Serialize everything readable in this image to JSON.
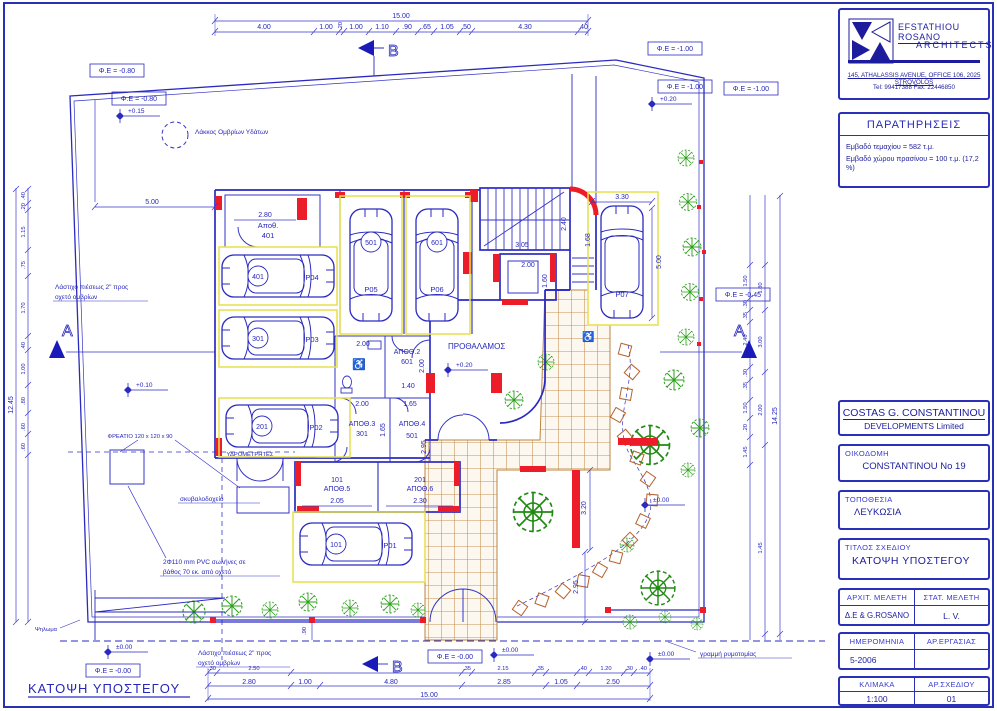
{
  "firm": {
    "name": "EFSTATHIOU ROSANO",
    "type": "ARCHITECTS",
    "address": "145, ATHALASSIS AVENUE, OFFICE 106, 2025 STROVOLOS",
    "contact": "Tel: 99417388    Fax: 22446850"
  },
  "remarks": {
    "title": "ΠΑΡΑΤΗΡΗΣΕΙΣ",
    "line1": "Εμβαδό τεμαχίου = 582 τ.μ.",
    "line2": "Εμβαδό χώρου πρασίνου = 100 τ.μ. (17,2 %)"
  },
  "client": {
    "name": "COSTAS G. CONSTANTINOU",
    "sub": "DEVELOPMENTS Limited"
  },
  "fields": {
    "building_label": "ΟΙΚΟΔΟΜΗ",
    "building": "CONSTANTINOU Νο 19",
    "location_label": "ΤΟΠΟΘΕΣΙΑ",
    "location": "ΛΕΥΚΩΣΙΑ",
    "title_label": "ΤΙΤΛΟΣ ΣΧΕΔΙΟΥ",
    "title": "ΚΑΤΟΨΗ ΥΠΟΣΤΕΓΟΥ",
    "arch_label": "ΑΡΧΙΤ. ΜΕΛΕΤΗ",
    "arch": "Δ.Ε & G.ROSANO",
    "struct_label": "ΣΤΑΤ. ΜΕΛΕΤΗ",
    "struct": "L. V.",
    "date_label": "ΗΜΕΡΟΜΗΝΙΑ",
    "date": "5-2006",
    "job_label": "ΑΡ.ΕΡΓΑΣΙΑΣ",
    "job": "",
    "scale_label": "ΚΛΙΜΑΚΑ",
    "scale": "1:100",
    "dwg_label": "ΑΡ.ΣΧΕΔΙΟΥ",
    "dwg": "01"
  },
  "plan": {
    "caption": "ΚΑΤΟΨΗ ΥΠΟΣΤΕΓΟΥ",
    "vestibule": "ΠΡΟΘΑΛΑΜΟΣ",
    "icons": {
      "wheelchair": "♿"
    },
    "notes": {
      "rain_pit": "Λάκκος Ομβρίων Υδάτων",
      "hose1": "Λάστιχο πιέσεως 2\" προς",
      "hose2": "οχετό ομβρίων",
      "street": "γραμμή ρυμοτομίας",
      "manhole": "ΦΡΕΑΤΙΟ 120 x 120 x 90",
      "bin": "σκυβαλοδοχείο",
      "pvc1": "2Φ110 mm PVC σωλήνες σε",
      "pvc2": "βάθος 70 εκ. από οχετό",
      "meters": "ΥΔΡΟΜΕΤΡΗΤΕΣ",
      "step": "Ψηλωμα"
    },
    "sections": {
      "a": "A",
      "b": "B"
    },
    "levels": [
      "+0.15",
      "+0.20",
      "+0.20",
      "+0.10",
      "±0.00",
      "±0.00",
      "±0.00",
      "±0.00"
    ],
    "fe": [
      "Φ.Ε = -0.80",
      "Φ.Ε = -0.80",
      "Φ.Ε = -1.00",
      "Φ.Ε = -1.00",
      "Φ.Ε = -1.00",
      "Φ.Ε = -0.45",
      "Φ.Ε = -0.00",
      "Φ.Ε = -0.00"
    ],
    "rooms": [
      {
        "name": "Αποθ.",
        "num": "401"
      },
      {
        "name": "ΑΠΟΘ.2",
        "num": "601"
      },
      {
        "name": "ΑΠΟΘ.3",
        "num": "301"
      },
      {
        "name": "ΑΠΟΘ.4",
        "num": "501"
      },
      {
        "name": "ΑΠΟΘ.5",
        "num": "101"
      },
      {
        "name": "ΑΠΟΘ.6",
        "num": "201"
      }
    ],
    "parking": [
      {
        "id": "P01",
        "unit": "101"
      },
      {
        "id": "P02",
        "unit": "201"
      },
      {
        "id": "P03",
        "unit": "301"
      },
      {
        "id": "P04",
        "unit": "401"
      },
      {
        "id": "P05",
        "unit": "501"
      },
      {
        "id": "P06",
        "unit": "601"
      },
      {
        "id": "P07",
        "unit": ""
      }
    ],
    "dims": {
      "top_total": "15.00",
      "top": [
        "4.00",
        "1.00",
        ".20",
        "1.00",
        "1.10",
        ".90",
        ".65",
        "1.05",
        ".50",
        "4.30",
        ".40"
      ],
      "bottom_total": "15.00",
      "bottom": [
        "2.80",
        "1.00",
        "4.80",
        "2.85",
        "1.05",
        "2.50"
      ],
      "bottom_small": [
        ".30",
        "2.50",
        ".35",
        "2.15",
        ".35",
        ".40",
        "1.20",
        ".30",
        ".40"
      ],
      "left_total": "12.45",
      "left": [
        ".40",
        ".20",
        "1.15",
        ".75",
        "1.70",
        ".40",
        "1.00",
        ".80",
        ".60",
        ".60"
      ],
      "right_total": "14.25",
      "right_inner": [
        "1.50",
        ".30",
        ".35",
        "2.40",
        ".30",
        ".35",
        "1.50",
        ".20",
        "1.45"
      ],
      "right_outer": [
        "1.80",
        "3.00",
        "2.00",
        "1.45"
      ],
      "site": "5.00",
      "room401": "2.80",
      "a2w": "2.00",
      "a2d": "2.00",
      "a2b": "1.40",
      "a3w": "2.00",
      "a3d": "1.65",
      "a4w": "1.65",
      "a4d": "2.95",
      "a5w": "2.05",
      "a6w": "2.30",
      "lift_w": "2.00",
      "lift_d": "1.60",
      "stair_w": "3.05",
      "stair_d": "2.40",
      "entry": "1.68",
      "p07w": "3.30",
      "p07d": "5.00",
      "g1": "3.20",
      "g2": "2.95",
      "strip": ".90"
    }
  }
}
